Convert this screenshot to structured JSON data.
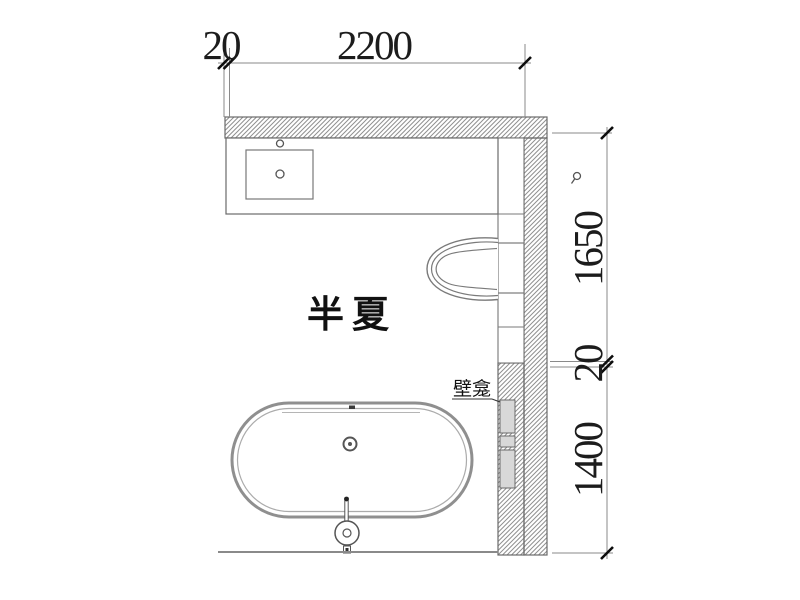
{
  "plan": {
    "project_name": "半夏",
    "niche_label": "壁龛"
  },
  "dimensions": {
    "top": {
      "offset": "20",
      "width": "2200"
    },
    "right": {
      "upper": "1650",
      "gap": "20",
      "lower": "1400"
    }
  },
  "colors": {
    "background": "#ffffff",
    "wall_line": "#6a6a6a",
    "hatch_line": "#8f8f8f",
    "fixture_line": "#7a7a7a",
    "tub_outline": "#8f8f8f",
    "dim_line": "#8a8a8a",
    "tick": "#0d0d0d",
    "text": "#1c1c1c",
    "niche_fill": "#d8d8d8"
  },
  "icons": {
    "marker": "cad-leader-dot"
  }
}
